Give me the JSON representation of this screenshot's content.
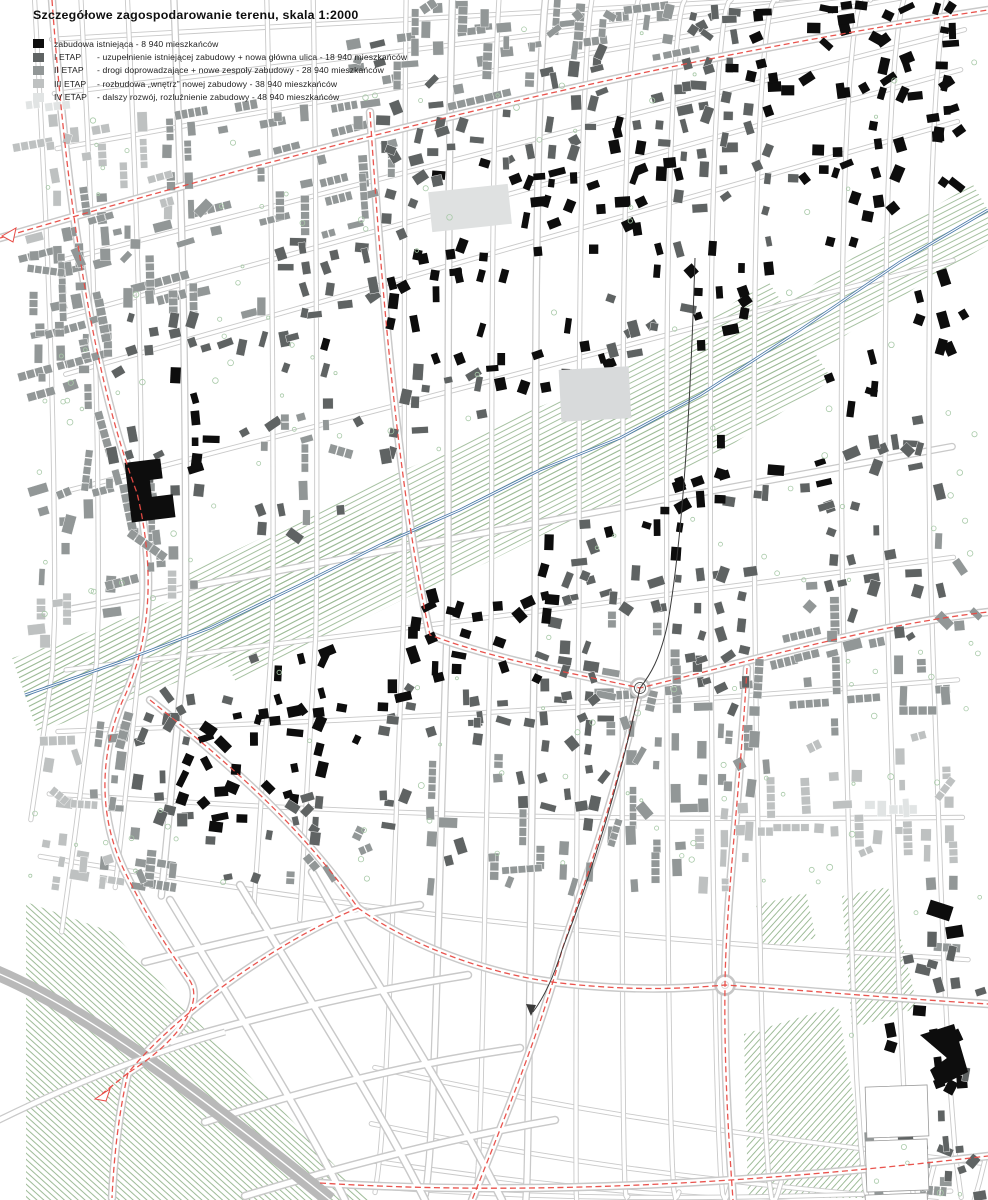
{
  "title": "Szczegółowe zagospodarowanie terenu, skala 1:2000",
  "legend": {
    "items": [
      {
        "label": "",
        "desc": "zabudowa istniejąca - 8 940 mieszkańców",
        "color": "#0d0d0d"
      },
      {
        "label": "I ETAP",
        "desc": "- uzupełnienie istniejącej zabudowy + nowa główna ulica - 18 940 mieszkańców",
        "color": "#5f6363"
      },
      {
        "label": "II ETAP",
        "desc": "- drogi doprowadzające + nowe zespoły zabudowy - 28 940 mieszkańców",
        "color": "#929797"
      },
      {
        "label": "III ETAP",
        "desc": "- rozbudowa „wnętrz” nowej zabudowy - 38 940 mieszkańców",
        "color": "#bec1c1"
      },
      {
        "label": "IV ETAP",
        "desc": "- dalszy rozwój, rozluźnienie zabudowy - 48 940 mieszkańców",
        "color": "#e1e4e4"
      }
    ]
  },
  "map": {
    "scale_label": "1:2000",
    "colors": {
      "existing": "#0d0d0d",
      "etap1": "#5f6363",
      "etap2": "#929797",
      "etap3": "#bec1c1",
      "etap4": "#e1e4e4",
      "road_casing": "#c9c9c9",
      "road_fill": "#ffffff",
      "main_road_red": "#e84b45",
      "river_blue": "#4d7bab",
      "green_hatch": "#9cba96",
      "tree_green": "#a8c9a8",
      "section_line": "#3a3a3a",
      "gray_road": "#b9b9b9"
    }
  }
}
